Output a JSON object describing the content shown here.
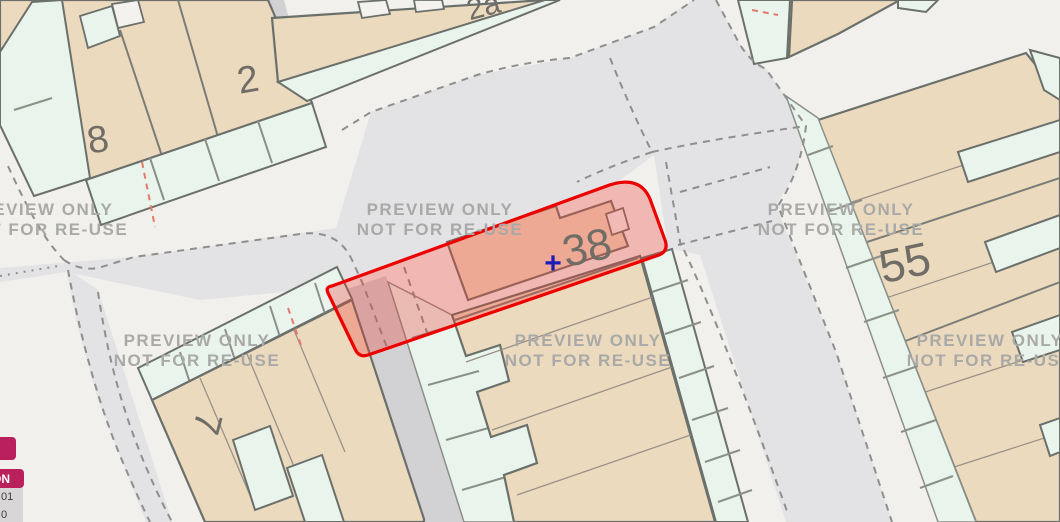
{
  "map": {
    "type": "property-boundary-map-preview",
    "watermark": {
      "line1": "PREVIEW ONLY",
      "line2": "NOT FOR RE-USE"
    },
    "house_numbers": {
      "n8": "8",
      "n2": "2",
      "n2a": "2a",
      "n55": "55",
      "n7": "7"
    },
    "selected_plot": {
      "number": "38",
      "marker": "+"
    },
    "colors": {
      "building_fill": "#ecdabf",
      "garden_fill": "#e9f4ec",
      "road_fill": "#e3e2e4",
      "minor_road_fill": "#d2d1d4",
      "pavement_fill": "#f2f0ec",
      "outline": "#6b706b",
      "plot_border": "#ec0000",
      "plot_fill_rgba": "rgba(237,55,45,0.30)",
      "marker_blue": "#1d1db5",
      "watermark_gray": "#a9a9a7",
      "boundary_dash_red": "#e5786f"
    }
  },
  "overlay": {
    "badge_text": "ON",
    "value_line1": "01",
    "value_line2": "0",
    "badge_color": "#b9205c"
  }
}
